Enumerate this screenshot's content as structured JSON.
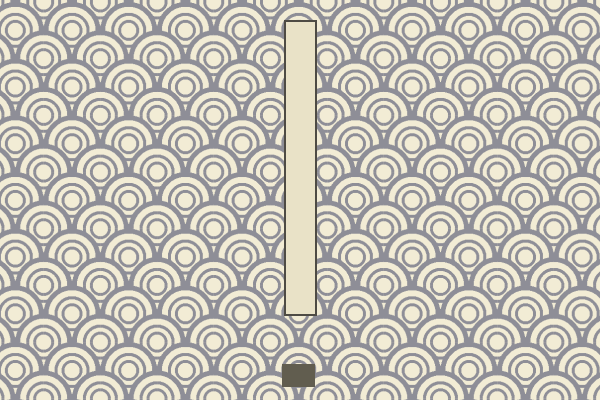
{
  "scene": {
    "name": "seigaiha-wave-game-scene",
    "background_pattern": "seigaiha-overlapping-wave-scallops",
    "objects": [
      {
        "name": "pillar",
        "type": "tall-vertical-bar",
        "fill": "#e9e2c7",
        "border": "#4e4b44"
      },
      {
        "name": "target-block",
        "type": "small-rectangle",
        "fill": "#615d4f"
      }
    ]
  },
  "colors": {
    "pattern-cream": "#f2ecd5",
    "pattern-gray": "#8e8e97",
    "pillar-fill": "#e9e2c7",
    "pillar-border": "#4e4b44",
    "block-fill": "#615d4f"
  }
}
